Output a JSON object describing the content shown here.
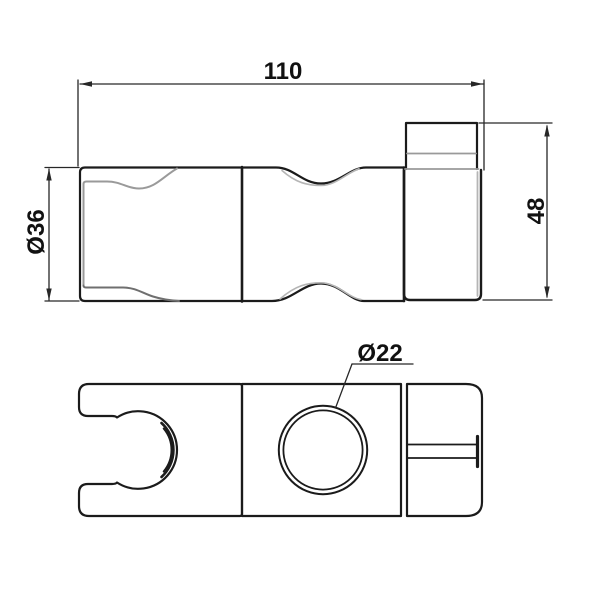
{
  "drawing": {
    "background_color": "#ffffff",
    "colors": {
      "outline": "#1b1b1b",
      "detail": "#9a9a9a",
      "detail_dark": "#6f6f6f",
      "detail_light": "#b5b5b5",
      "dimension": "#272727",
      "label": "#111111"
    },
    "dimensions": {
      "overall_length": {
        "label": "110"
      },
      "collar_height": {
        "label": "48"
      },
      "cup_diameter": {
        "label": "Ø36"
      },
      "hole_diameter": {
        "label": "Ø22"
      }
    }
  }
}
